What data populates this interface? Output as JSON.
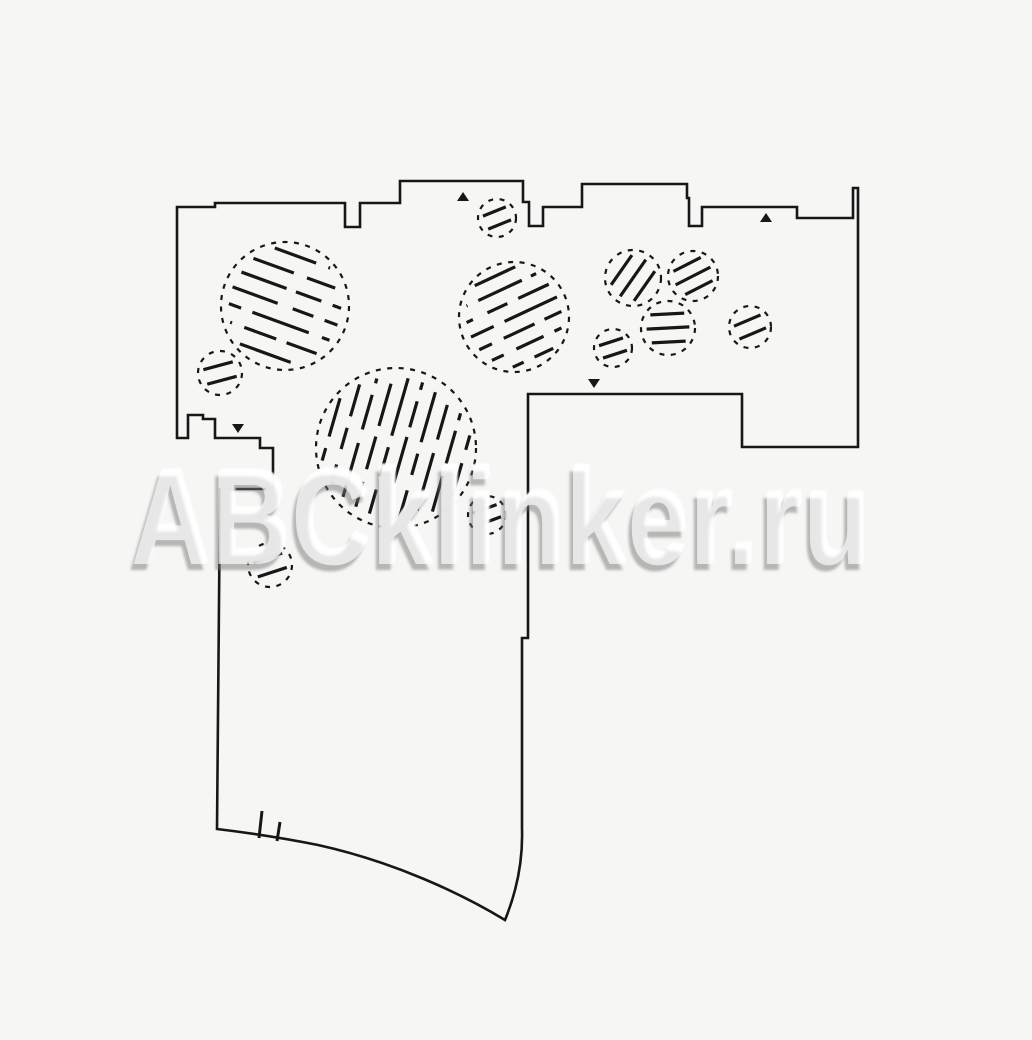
{
  "watermark": {
    "text": "ABCklinker.ru"
  },
  "canvas": {
    "width": 1032,
    "height": 1040,
    "background_color": "#f6f6f4",
    "line_color": "#171717"
  },
  "plan": {
    "outline_path": "M 177,207 L 215,207 L 215,203 L 345,203 L 345,227 L 360,227 L 360,203 L 400,203 L 400,181 L 523,181 L 523,202 L 529,202 L 529,226 L 543,226 L 543,207 L 582,207 L 582,184 L 687,184 L 687,198 L 689,198 L 689,226 L 702,226 L 702,207 L 797,207 L 797,218 L 853,218 L 853,188 L 858,188 L 858,447 L 742,447 L 742,394 L 528,394 L 528,638 L 522,638 L 522,829 C 523,862 516,893 505,920 C 462,894 395,862 318,845 C 278,837 242,832 217,829 L 220,489 L 273,489 L 273,448 L 260,448 L 260,438 L 215,438 L 215,419 L 203,419 L 203,415 L 188,415 L 188,438 L 177,438 Z",
    "outline_stroke_width": 2.6,
    "hatched_circles": [
      {
        "cx": 285,
        "cy": 306,
        "r": 64,
        "angle": 20,
        "lines": 7,
        "spacing": 17,
        "style": "broken"
      },
      {
        "cx": 514,
        "cy": 317,
        "r": 55,
        "angle": -25,
        "lines": 7,
        "spacing": 15,
        "style": "broken"
      },
      {
        "cx": 396,
        "cy": 448,
        "r": 80,
        "angle": -74,
        "lines": 10,
        "spacing": 15,
        "style": "broken"
      },
      {
        "cx": 220,
        "cy": 373,
        "r": 22,
        "angle": -15,
        "lines": 2,
        "spacing": 15,
        "style": "solid"
      },
      {
        "cx": 497,
        "cy": 218,
        "r": 19,
        "angle": -22,
        "lines": 2,
        "spacing": 14,
        "style": "solid"
      },
      {
        "cx": 270,
        "cy": 565,
        "r": 22,
        "angle": -18,
        "lines": 2,
        "spacing": 15,
        "style": "solid"
      },
      {
        "cx": 487,
        "cy": 515,
        "r": 19,
        "angle": -20,
        "lines": 2,
        "spacing": 13,
        "style": "solid"
      },
      {
        "cx": 633,
        "cy": 278,
        "r": 28,
        "angle": -55,
        "lines": 3,
        "spacing": 14,
        "style": "solid"
      },
      {
        "cx": 693,
        "cy": 276,
        "r": 25,
        "angle": -27,
        "lines": 3,
        "spacing": 13,
        "style": "solid"
      },
      {
        "cx": 613,
        "cy": 348,
        "r": 19,
        "angle": -18,
        "lines": 2,
        "spacing": 13,
        "style": "solid"
      },
      {
        "cx": 668,
        "cy": 328,
        "r": 27,
        "angle": -3,
        "lines": 3,
        "spacing": 14,
        "style": "solid"
      },
      {
        "cx": 750,
        "cy": 327,
        "r": 21,
        "angle": -23,
        "lines": 2,
        "spacing": 14,
        "style": "solid"
      }
    ],
    "direction_markers": [
      {
        "x": 463,
        "y": 197,
        "dir": "up"
      },
      {
        "x": 766,
        "y": 218,
        "dir": "up"
      },
      {
        "x": 594,
        "y": 383,
        "dir": "down"
      },
      {
        "x": 238,
        "y": 428,
        "dir": "down"
      }
    ],
    "boundary_ticks": [
      {
        "x1": 262,
        "y1": 811,
        "x2": 259,
        "y2": 838
      },
      {
        "x1": 280,
        "y1": 822,
        "x2": 277,
        "y2": 841
      }
    ]
  }
}
